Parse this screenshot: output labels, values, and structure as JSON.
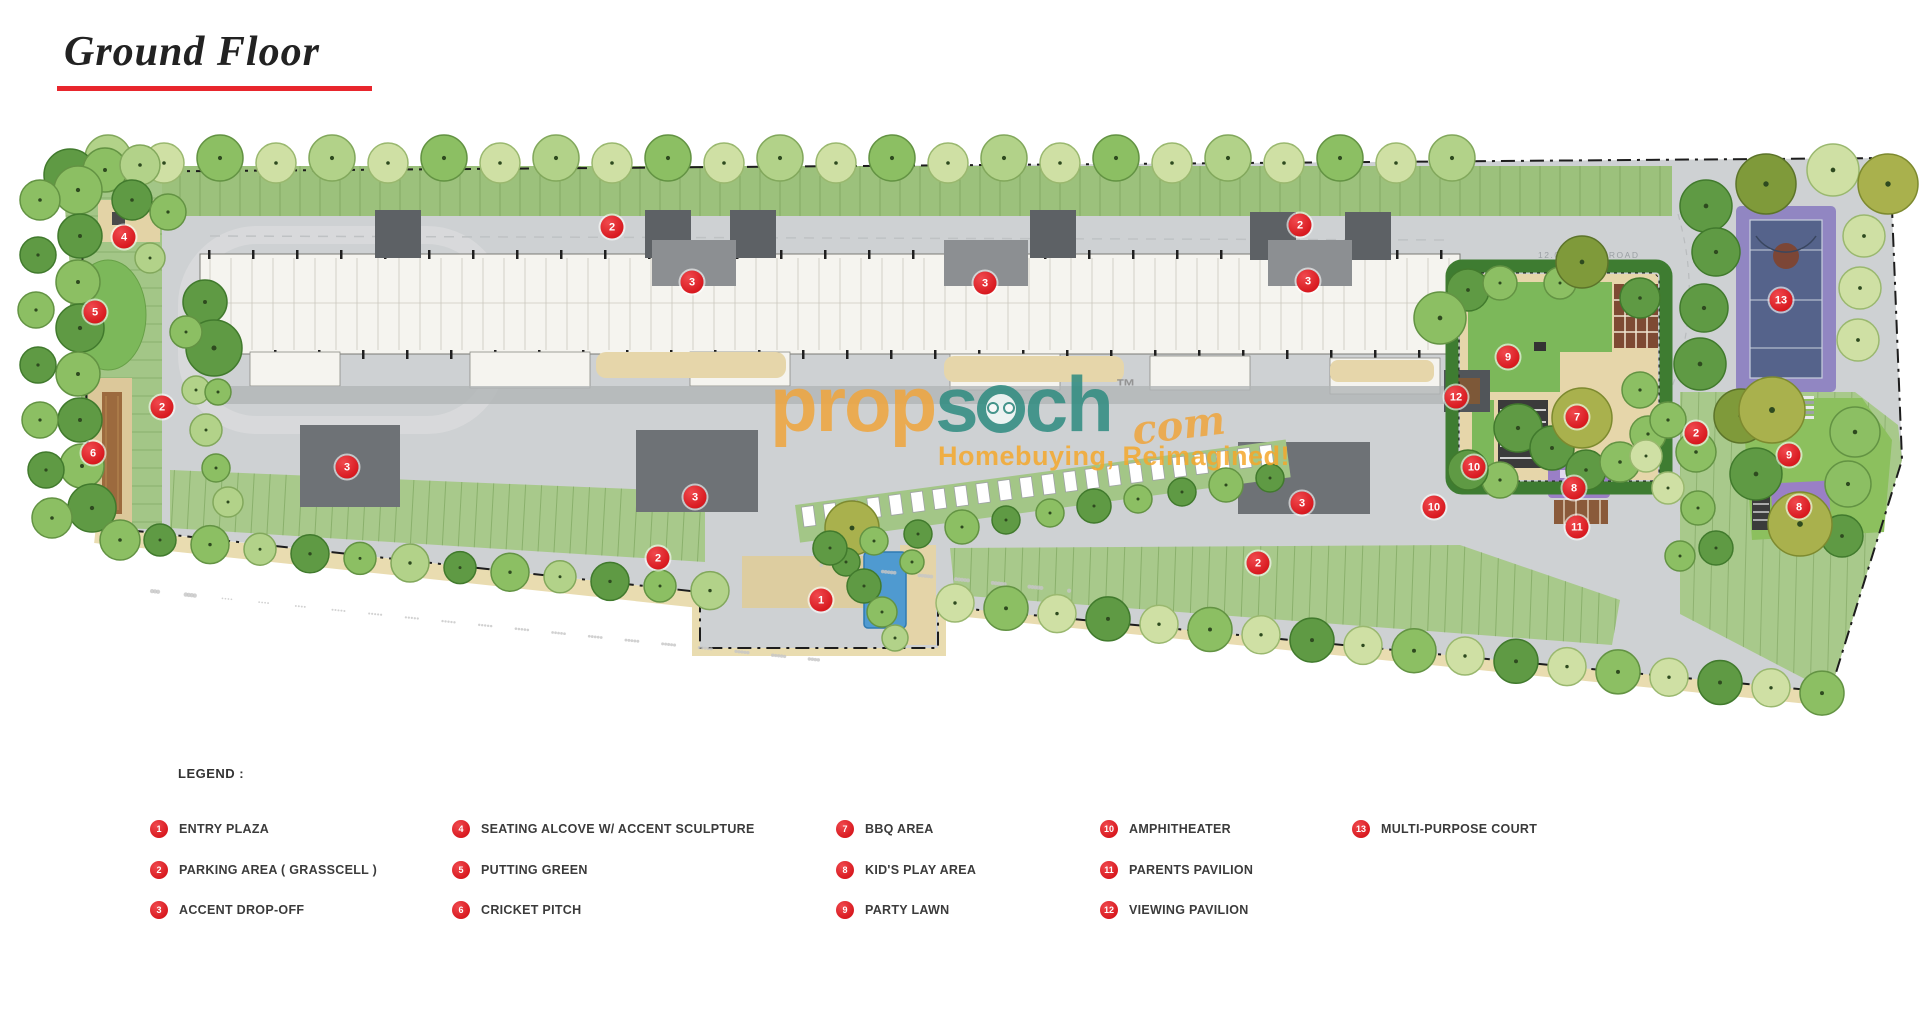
{
  "title": {
    "text": "Ground Floor"
  },
  "watermark": {
    "brand_prefix": "prop",
    "brand_mid": "s",
    "brand_suffix": "ch",
    "tld": "com",
    "tm": "™",
    "tagline": "Homebuying, Reimagined!",
    "orange": "#f0a53c",
    "teal": "#2e8b80"
  },
  "plan": {
    "road_label": "12.0 M WIDE ROAD",
    "markers": [
      {
        "n": "4",
        "x": 124,
        "y": 237
      },
      {
        "n": "5",
        "x": 95,
        "y": 312
      },
      {
        "n": "2",
        "x": 162,
        "y": 407
      },
      {
        "n": "6",
        "x": 93,
        "y": 453
      },
      {
        "n": "2",
        "x": 612,
        "y": 227
      },
      {
        "n": "3",
        "x": 692,
        "y": 282
      },
      {
        "n": "3",
        "x": 985,
        "y": 283
      },
      {
        "n": "2",
        "x": 1300,
        "y": 225
      },
      {
        "n": "3",
        "x": 1308,
        "y": 281
      },
      {
        "n": "3",
        "x": 347,
        "y": 467
      },
      {
        "n": "3",
        "x": 695,
        "y": 497
      },
      {
        "n": "3",
        "x": 1302,
        "y": 503
      },
      {
        "n": "2",
        "x": 658,
        "y": 558
      },
      {
        "n": "2",
        "x": 1258,
        "y": 563
      },
      {
        "n": "1",
        "x": 821,
        "y": 600
      },
      {
        "n": "9",
        "x": 1508,
        "y": 357
      },
      {
        "n": "12",
        "x": 1456,
        "y": 397
      },
      {
        "n": "7",
        "x": 1577,
        "y": 417
      },
      {
        "n": "10",
        "x": 1474,
        "y": 467
      },
      {
        "n": "8",
        "x": 1574,
        "y": 488
      },
      {
        "n": "11",
        "x": 1577,
        "y": 527
      },
      {
        "n": "10",
        "x": 1434,
        "y": 507
      },
      {
        "n": "13",
        "x": 1781,
        "y": 300
      },
      {
        "n": "2",
        "x": 1696,
        "y": 433
      },
      {
        "n": "9",
        "x": 1789,
        "y": 455
      },
      {
        "n": "8",
        "x": 1799,
        "y": 507
      }
    ]
  },
  "legend": {
    "heading": "LEGEND :",
    "columns": [
      {
        "items": [
          {
            "n": "1",
            "label": "ENTRY PLAZA"
          },
          {
            "n": "2",
            "label": "PARKING AREA ( GRASSCELL )"
          },
          {
            "n": "3",
            "label": "ACCENT DROP-OFF"
          }
        ]
      },
      {
        "items": [
          {
            "n": "4",
            "label": "SEATING ALCOVE W/ ACCENT SCULPTURE"
          },
          {
            "n": "5",
            "label": "PUTTING GREEN"
          },
          {
            "n": "6",
            "label": "CRICKET PITCH"
          }
        ]
      },
      {
        "items": [
          {
            "n": "7",
            "label": "BBQ AREA"
          },
          {
            "n": "8",
            "label": "KID'S PLAY AREA"
          },
          {
            "n": "9",
            "label": "PARTY LAWN"
          }
        ]
      },
      {
        "items": [
          {
            "n": "10",
            "label": "AMPHITHEATER"
          },
          {
            "n": "11",
            "label": "PARENTS PAVILION"
          },
          {
            "n": "12",
            "label": "VIEWING PAVILION"
          }
        ]
      },
      {
        "items": [
          {
            "n": "13",
            "label": "MULTI-PURPOSE COURT"
          }
        ]
      }
    ]
  },
  "colors": {
    "accent_red": "#e8262d",
    "marker_red": "#d8191f",
    "road_gray": "#ced1d3",
    "grass_green": "#9cc17c",
    "lawn_green": "#7cb85a",
    "court_purple": "#9186c2",
    "water_blue": "#4f9ad0"
  }
}
